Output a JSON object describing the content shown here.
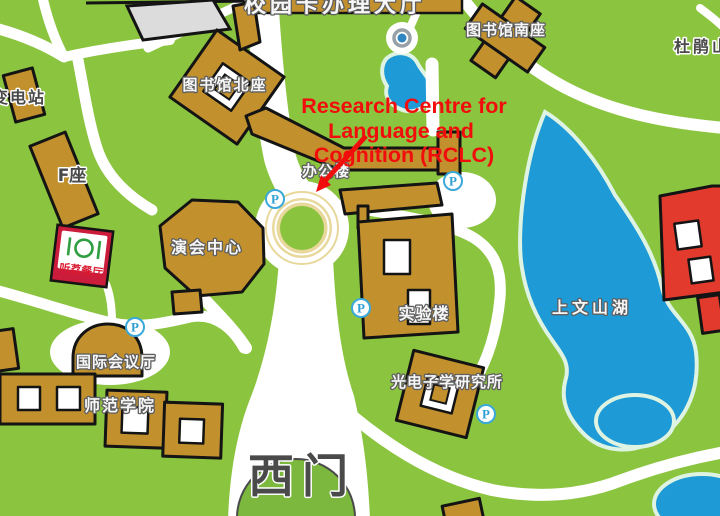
{
  "map": {
    "annotation": {
      "line1": "Research Centre for",
      "line2": "Language and",
      "line3": "Cognition (RCLC)"
    },
    "labels": {
      "campus_card_hall": "校园卡办理大厅",
      "library_north": "图书馆北座",
      "library_south": "图书馆南座",
      "azalea_hill": "杜鹃山",
      "substation": "变电站",
      "f_block": "F座",
      "performance_center": "演会中心",
      "office_building": "办公楼",
      "canteen": "听荔餐厅",
      "international_conference_hall": "国际会议厅",
      "normal_college": "师范学院",
      "laboratory_building": "实验楼",
      "optoelectronics_institute": "光电子学研究所",
      "shangwenshan_lake": "上文山湖",
      "west_gate": "西门",
      "parking_badge": "P"
    },
    "colors": {
      "grass": "#8bc43f",
      "road": "#ffffff",
      "building": "#c2912d",
      "building_outline": "#141414",
      "highlight_building": "#e23a2c",
      "gray_building": "#dcdcdc",
      "lake": "#1e9ad6",
      "lake_outline": "#def3e2",
      "roundabout_ring": "#e8d89c",
      "gate_dome_green": "#7cb83e",
      "parking_blue": "#2e9fd4",
      "canteen_red": "#cc1c3c",
      "annotation_red": "#f20d0d"
    }
  }
}
